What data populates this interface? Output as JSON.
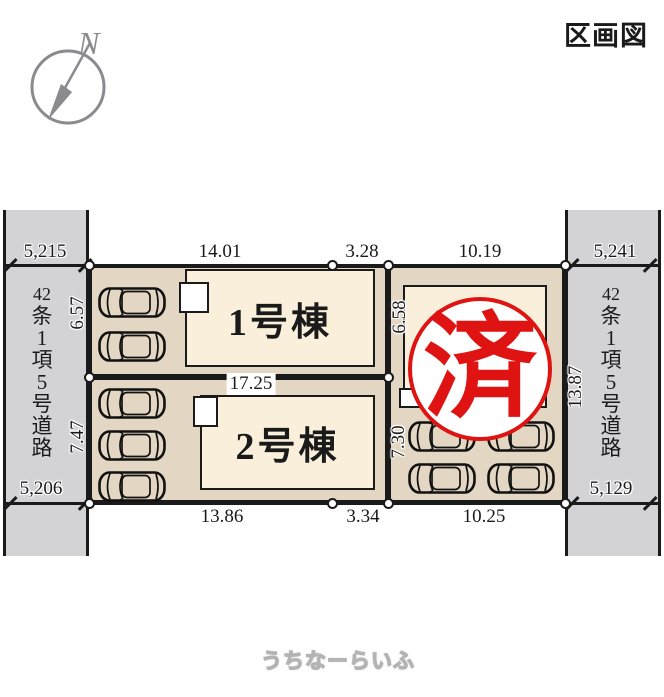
{
  "header": {
    "title": "区画図",
    "compass_label": "N"
  },
  "roads": {
    "left": {
      "name": "42条1項5号道路",
      "chars": [
        "42",
        "条",
        "1",
        "項",
        "5",
        "号",
        "道",
        "路"
      ]
    },
    "right": {
      "name": "42条1項5号道路",
      "chars": [
        "42",
        "条",
        "1",
        "項",
        "5",
        "号",
        "道",
        "路"
      ]
    }
  },
  "plots": {
    "plot1": {
      "building_label": "1号棟"
    },
    "plot2": {
      "building_label": "2号棟"
    },
    "plot3": {
      "stamp_text": "済"
    }
  },
  "dimensions": {
    "top": {
      "left_road": "5,215",
      "plot1_main": "14.01",
      "plot1_side": "3.28",
      "plot3": "10.19",
      "right_road": "5,241"
    },
    "bottom": {
      "left_road": "5,206",
      "plot2_main": "13.86",
      "plot2_side": "3.34",
      "plot3": "10.25",
      "right_road": "5,129"
    },
    "middle": {
      "plot2_top": "17.25"
    },
    "vertical": {
      "plot1_left": "6.57",
      "plot2_left": "7.47",
      "plot3_upper": "6.58",
      "plot3_lower": "7.30",
      "right_side": "13.87"
    }
  },
  "watermark": {
    "text": "うちなーらいふ"
  },
  "colors": {
    "road": "#d3d3d5",
    "plot": "#e3d6c2",
    "building": "#f9efdb",
    "line": "#1a1a1a",
    "stamp_red": "#e01313",
    "compass_gray": "#8b8b8f"
  }
}
